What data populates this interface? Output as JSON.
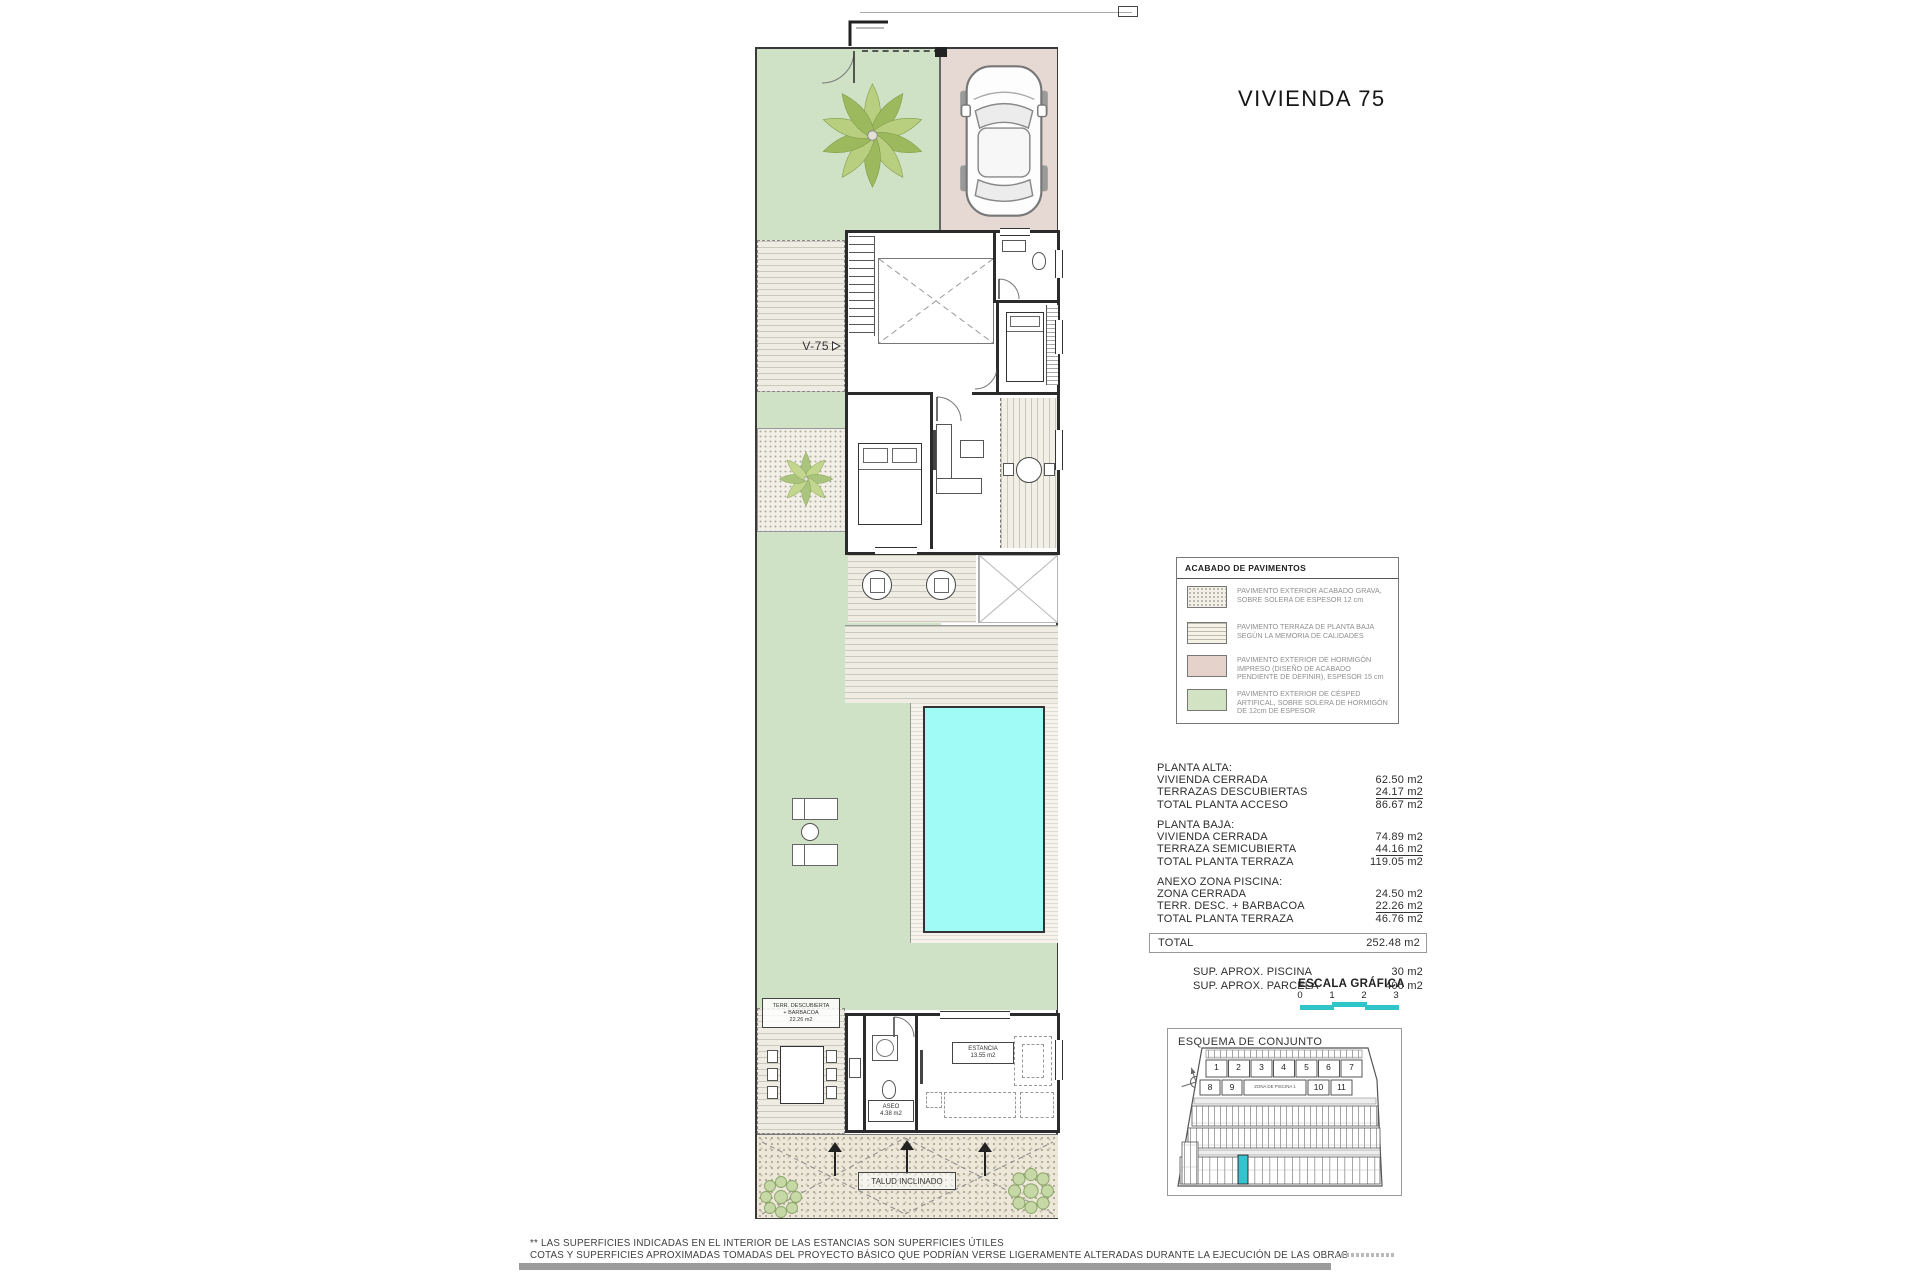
{
  "title": "VIVIENDA 75",
  "plan": {
    "v75_label": "V-75",
    "talud_label": "TALUD INCLINADO",
    "terraza_box": {
      "l1": "TERR. DESCUBIERTA",
      "l2": "+ BARBACOA",
      "l3": "22.26 m2"
    },
    "aseo_box": {
      "l1": "ASEO",
      "l2": "4.38 m2"
    },
    "estancia_box": {
      "l1": "ESTANCIA",
      "l2": "13.55 m2"
    }
  },
  "legend": {
    "title": "ACABADO DE PAVIMENTOS",
    "items": [
      {
        "name": "gravel-swatch",
        "text": "PAVIMENTO EXTERIOR ACABADO GRAVA, SOBRE SOLERA DE ESPESOR 12 cm"
      },
      {
        "name": "terrace-swatch",
        "text": "PAVIMENTO TERRAZA DE PLANTA BAJA SEGÚN LA MEMORIA DE CALIDADES"
      },
      {
        "name": "concrete-swatch",
        "text": "PAVIMENTO EXTERIOR DE HORMIGÓN IMPRESO (DISEÑO DE ACABADO PENDIENTE DE DEFINIR), ESPESOR 15 cm"
      },
      {
        "name": "grass-swatch",
        "text": "PAVIMENTO EXTERIOR DE CÉSPED ARTIFICAL, SOBRE SOLERA DE HORMIGÓN DE 12cm DE ESPESOR"
      }
    ]
  },
  "areas": {
    "planta_alta": {
      "title": "PLANTA ALTA:",
      "rows": [
        {
          "label": "VIVIENDA CERRADA",
          "value": "62.50 m2"
        },
        {
          "label": "TERRAZAS DESCUBIERTAS",
          "value": "24.17 m2"
        },
        {
          "label": "TOTAL PLANTA ACCESO",
          "value": "86.67 m2"
        }
      ]
    },
    "planta_baja": {
      "title": "PLANTA BAJA:",
      "rows": [
        {
          "label": "VIVIENDA CERRADA",
          "value": "74.89 m2"
        },
        {
          "label": "TERRAZA SEMICUBIERTA",
          "value": "44.16 m2"
        },
        {
          "label": "TOTAL PLANTA TERRAZA",
          "value": "119.05 m2"
        }
      ]
    },
    "anexo": {
      "title": "ANEXO ZONA PISCINA:",
      "rows": [
        {
          "label": "ZONA CERRADA",
          "value": "24.50 m2"
        },
        {
          "label": "TERR. DESC. + BARBACOA",
          "value": "22.26 m2"
        },
        {
          "label": "TOTAL PLANTA TERRAZA",
          "value": "46.76 m2"
        }
      ]
    },
    "total": {
      "label": "TOTAL",
      "value": "252.48 m2"
    },
    "sup_piscina": {
      "label": "SUP.  APROX. PISCINA",
      "value": "30 m2"
    },
    "sup_parcela": {
      "label": "SUP.  APROX. PARCELA",
      "value": "400 m2"
    }
  },
  "escala": {
    "title": "ESCALA GRÁFICA",
    "ticks": [
      "0",
      "1",
      "2",
      "3"
    ]
  },
  "esquema": {
    "title": "ESQUEMA DE CONJUNTO",
    "row1": [
      "1",
      "2",
      "3",
      "4",
      "5",
      "6",
      "7"
    ],
    "row2": [
      "8",
      "9"
    ],
    "zona_label": "ZONA DE PISCINA 1",
    "row2b": [
      "10",
      "11"
    ]
  },
  "footer": {
    "line1": "** LAS SUPERFICIES INDICADAS EN EL INTERIOR DE LAS ESTANCIAS SON SUPERFICIES ÚTILES",
    "line2": "COTAS Y SUPERFICIES APROXIMADAS TOMADAS DEL PROYECTO BÁSICO QUE PODRÍAN VERSE LIGERAMENTE ALTERADAS DURANTE LA EJECUCIÓN DE LAS OBRAS"
  },
  "colors": {
    "lawn": "#cfe2c6",
    "driveway": "#e6d9d3",
    "pool": "#a0fbf6",
    "scale_bar": "#2fc5c8",
    "highlight_unit": "#35c4cf"
  }
}
